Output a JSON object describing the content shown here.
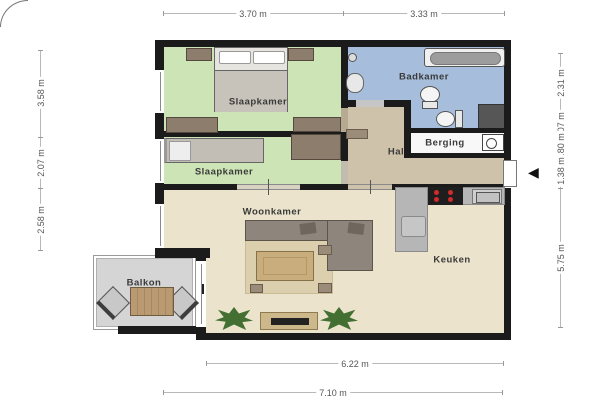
{
  "floorplan": {
    "rooms": [
      {
        "label": "Slaapkamer"
      },
      {
        "label": "Slaapkamer"
      },
      {
        "label": "Badkamer"
      },
      {
        "label": "Berging"
      },
      {
        "label": "Hal"
      },
      {
        "label": "Woonkamer"
      },
      {
        "label": "Keuken"
      },
      {
        "label": "Balkon"
      }
    ],
    "entrance_marker": "◀"
  },
  "dimensions": {
    "top": [
      "3.70 m",
      "3.33 m"
    ],
    "left": [
      "3.58 m",
      "2.07 m",
      "2.58 m"
    ],
    "right": [
      "2.31 m",
      "1.07 m",
      "0.80 m",
      "1.38 m",
      "5.75 m"
    ],
    "bottom": [
      "6.22 m",
      "7.10 m"
    ]
  },
  "colors": {
    "wall": "#1b1b1b",
    "bedroom": "#cde5b6",
    "bathroom": "#a6bedc",
    "hallway": "#cfc2ab",
    "living": "#ebe3cc",
    "storage": "#f8f8f8",
    "balcony": "#d5d5d5",
    "shaft": "#565656",
    "counter": "#b6b6b6",
    "wood": "#8d7d6c",
    "dim_text": "#555555",
    "label_text": "#3a3a3a"
  }
}
